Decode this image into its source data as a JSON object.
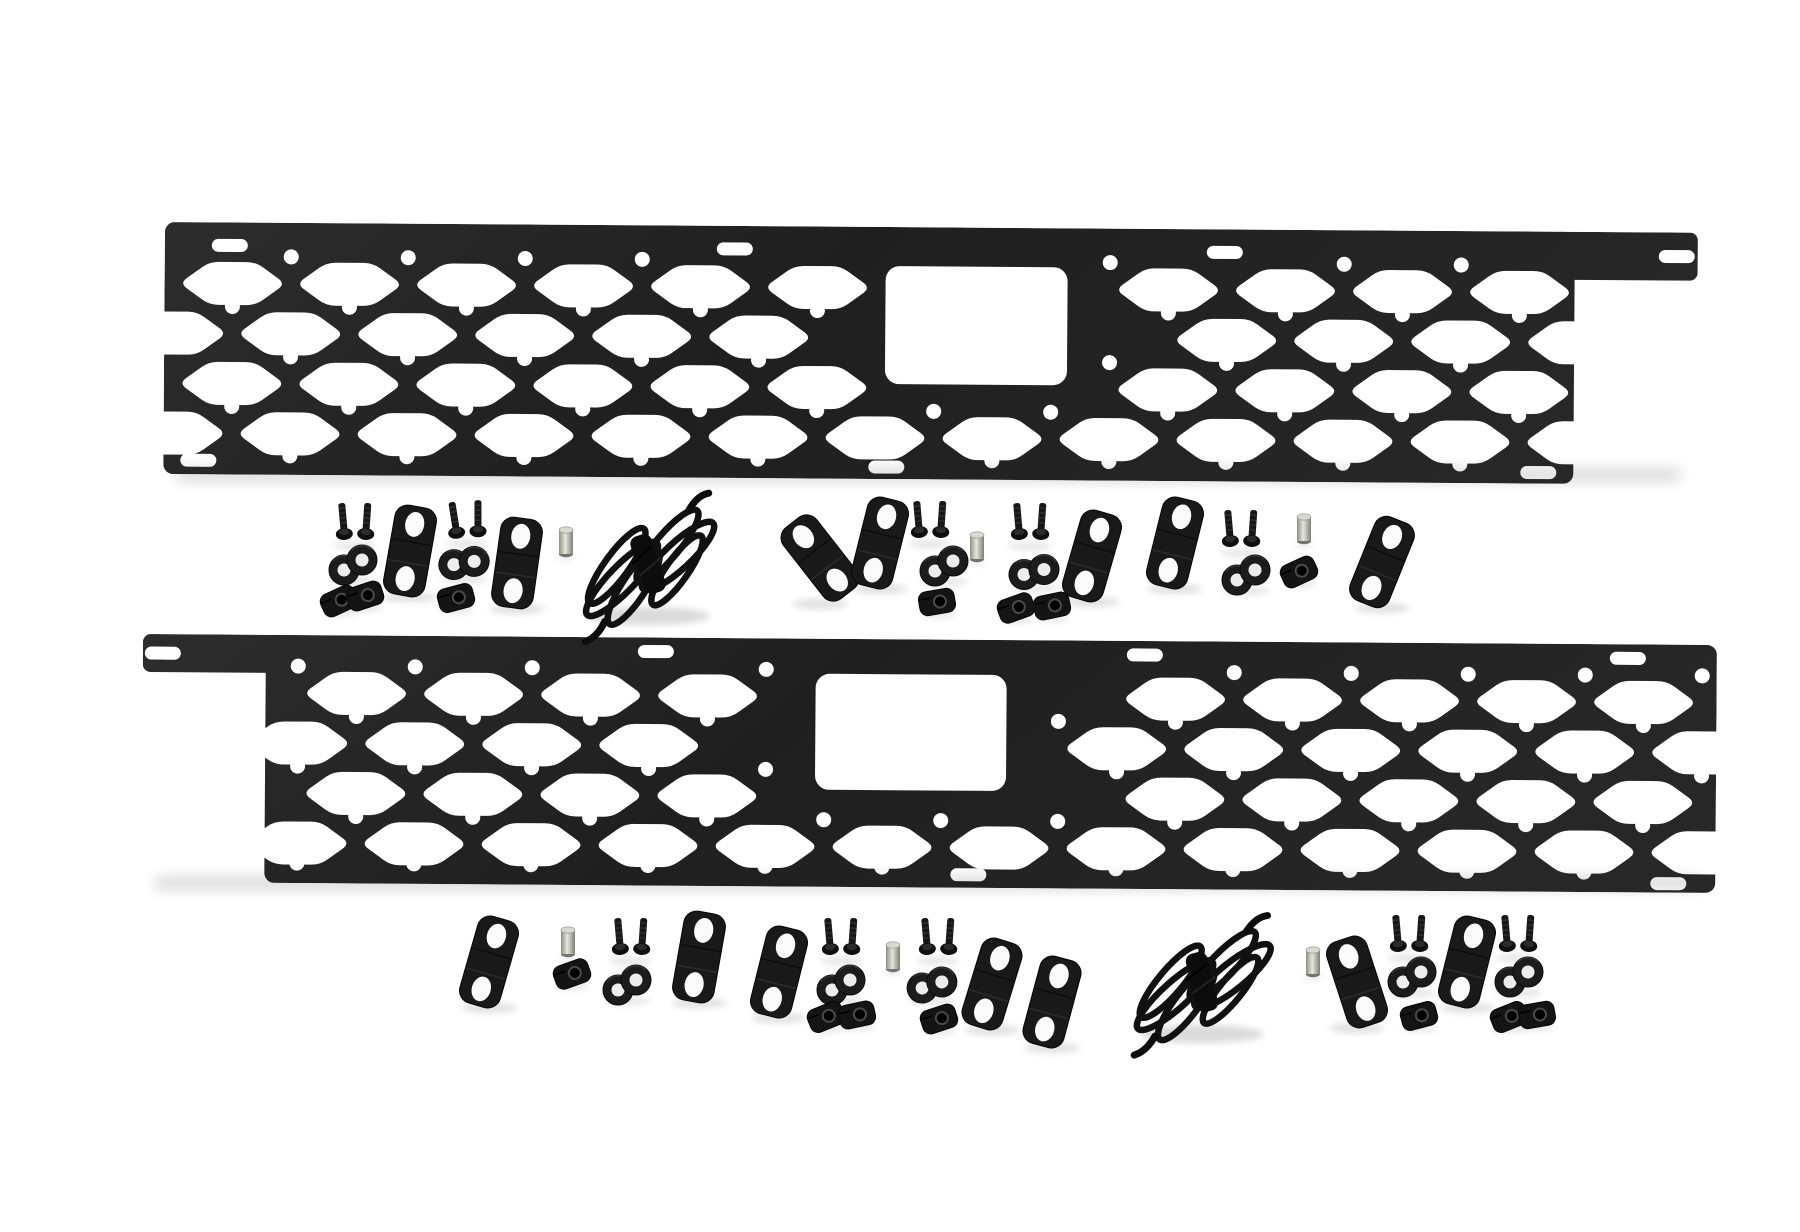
{
  "scene": {
    "type": "product-photo",
    "description": "Truck bed rail MOLLE panel kit: two long black powder-coated panels with hexagonal cutouts shown with mounting hardware (Z-brackets, button-head bolts, washers, U-clip nuts, threaded spacers, coiled rubber straps) on a white studio background.",
    "background_color": "#ffffff",
    "text_content": []
  },
  "palette": {
    "panel_dark": "#1f1f1f",
    "panel_mid": "#272727",
    "panel_light": "#2d2d2d",
    "hardware_black": "#171717",
    "hole_white": "#fbfbfb",
    "washer_hole": "#ededed",
    "stud_silver_light": "#e6e6df",
    "stud_silver_dark": "#8e8e88",
    "shadow": "#000000"
  },
  "kit_summary": {
    "molle_panels": 2,
    "z_brackets": 14,
    "bolt_pairs": 10,
    "washer_pairs": 10,
    "clip_nuts": 14,
    "spacer_studs": 6,
    "strap_coils": 2
  },
  "panels": [
    {
      "name": "molle-panel-top",
      "x": 125,
      "y": 206,
      "rotation": 0.4,
      "total_w": 1533,
      "body": {
        "x": 0,
        "w": 1410,
        "h": 252,
        "r": 10
      },
      "arm": {
        "x": 1385,
        "w": 148,
        "h": 48,
        "r": 8
      },
      "hex": {
        "w": 106,
        "h": 43,
        "taper": 30,
        "pitch": 117,
        "row_ys": [
          61,
          111,
          161,
          211
        ],
        "even_offset": 68,
        "odd_offset": 9.5,
        "field_x0": 12,
        "field_x1": 1398
      },
      "holes": {
        "r": 7.5,
        "line_ys": [
          34,
          84,
          134,
          184,
          233
        ],
        "offsets": [
          126.5,
          68
        ]
      },
      "rect_cutout": {
        "x": 721,
        "y": 39,
        "w": 182,
        "h": 118,
        "r": 14
      },
      "slot_size": {
        "w": 36,
        "h": 13,
        "r": 6.5
      },
      "slots": [
        [
          65,
          23
        ],
        [
          570,
          23
        ],
        [
          1060,
          23
        ],
        [
          1512,
          24
        ],
        [
          35,
          238
        ],
        [
          723,
          240
        ],
        [
          1375,
          241
        ]
      ]
    },
    {
      "name": "molle-panel-bottom",
      "x": 103,
      "y": 618,
      "rotation": 0.4,
      "total_w": 1574,
      "body": {
        "x": 123,
        "w": 1451,
        "h": 248,
        "r": 10
      },
      "arm": {
        "x": 0,
        "w": 148,
        "h": 38,
        "r": 8
      },
      "hex": {
        "w": 106,
        "h": 43,
        "taper": 30,
        "pitch": 117,
        "row_ys": [
          58,
          108,
          158,
          208
        ],
        "even_offset": 214,
        "odd_offset": 155.5,
        "field_x0": 136,
        "field_x1": 1560
      },
      "holes": {
        "r": 7.5,
        "line_ys": [
          31,
          81,
          131,
          181,
          228
        ],
        "offsets": [
          155.5,
          214
        ]
      },
      "rect_cutout": {
        "x": 673,
        "y": 35,
        "w": 191,
        "h": 116,
        "r": 14
      },
      "slot_size": {
        "w": 36,
        "h": 13,
        "r": 6.5
      },
      "slots": [
        [
          20,
          19
        ],
        [
          513,
          14
        ],
        [
          1002,
          14
        ],
        [
          1485,
          14
        ],
        [
          95,
          233
        ],
        [
          827,
          235
        ],
        [
          1527,
          239
        ]
      ]
    }
  ],
  "hardware_between_panels": [
    {
      "type": "screw-pair",
      "x": 315,
      "y": 514,
      "rot": 0
    },
    {
      "type": "washer-pair",
      "x": 313,
      "y": 549,
      "rot": 0
    },
    {
      "type": "clip-nut",
      "x": 299,
      "y": 585,
      "rot": -25
    },
    {
      "type": "clip-nut",
      "x": 325,
      "y": 580,
      "rot": -18
    },
    {
      "type": "z-bracket",
      "x": 370,
      "y": 535,
      "rot": 10
    },
    {
      "type": "screw-pair",
      "x": 427,
      "y": 512,
      "rot": -4
    },
    {
      "type": "washer-pair",
      "x": 424,
      "y": 547,
      "rot": 20
    },
    {
      "type": "clip-nut",
      "x": 416,
      "y": 582,
      "rot": -15
    },
    {
      "type": "z-bracket",
      "x": 477,
      "y": 547,
      "rot": 8
    },
    {
      "type": "spacer-stud",
      "x": 526,
      "y": 526,
      "rot": 0
    },
    {
      "type": "strap-coil",
      "x": 608,
      "y": 548,
      "rot": -30
    },
    {
      "type": "z-bracket",
      "x": 780,
      "y": 542,
      "rot": -38
    },
    {
      "type": "z-bracket",
      "x": 840,
      "y": 527,
      "rot": 14
    },
    {
      "type": "screw-pair",
      "x": 890,
      "y": 512,
      "rot": 0
    },
    {
      "type": "washer-pair",
      "x": 904,
      "y": 550,
      "rot": 0
    },
    {
      "type": "clip-nut",
      "x": 897,
      "y": 586,
      "rot": -10
    },
    {
      "type": "spacer-stud",
      "x": 937,
      "y": 531,
      "rot": 0
    },
    {
      "type": "screw-pair",
      "x": 990,
      "y": 514,
      "rot": 0
    },
    {
      "type": "washer-pair",
      "x": 994,
      "y": 556,
      "rot": 15
    },
    {
      "type": "clip-nut",
      "x": 976,
      "y": 592,
      "rot": -20
    },
    {
      "type": "clip-nut",
      "x": 1012,
      "y": 590,
      "rot": -12
    },
    {
      "type": "z-bracket",
      "x": 1052,
      "y": 540,
      "rot": 16
    },
    {
      "type": "z-bracket",
      "x": 1135,
      "y": 527,
      "rot": 14
    },
    {
      "type": "screw-pair",
      "x": 1201,
      "y": 521,
      "rot": 0
    },
    {
      "type": "washer-pair",
      "x": 1206,
      "y": 559,
      "rot": 0
    },
    {
      "type": "spacer-stud",
      "x": 1264,
      "y": 513,
      "rot": 0
    },
    {
      "type": "clip-nut",
      "x": 1259,
      "y": 556,
      "rot": -25
    },
    {
      "type": "z-bracket",
      "x": 1342,
      "y": 546,
      "rot": 22
    }
  ],
  "hardware_below_panels": [
    {
      "type": "z-bracket",
      "x": 449,
      "y": 946,
      "rot": 16
    },
    {
      "type": "spacer-stud",
      "x": 528,
      "y": 926,
      "rot": 0
    },
    {
      "type": "clip-nut",
      "x": 532,
      "y": 958,
      "rot": -20
    },
    {
      "type": "screw-pair",
      "x": 591,
      "y": 929,
      "rot": 0
    },
    {
      "type": "washer-pair",
      "x": 587,
      "y": 969,
      "rot": 0
    },
    {
      "type": "z-bracket",
      "x": 659,
      "y": 941,
      "rot": 10
    },
    {
      "type": "z-bracket",
      "x": 739,
      "y": 956,
      "rot": 14
    },
    {
      "type": "screw-pair",
      "x": 801,
      "y": 929,
      "rot": 0
    },
    {
      "type": "washer-pair",
      "x": 801,
      "y": 969,
      "rot": 0
    },
    {
      "type": "clip-nut",
      "x": 786,
      "y": 1001,
      "rot": -22
    },
    {
      "type": "clip-nut",
      "x": 817,
      "y": 999,
      "rot": -12
    },
    {
      "type": "spacer-stud",
      "x": 853,
      "y": 941,
      "rot": 0
    },
    {
      "type": "screw-pair",
      "x": 898,
      "y": 929,
      "rot": 0
    },
    {
      "type": "washer-pair",
      "x": 892,
      "y": 969,
      "rot": 12
    },
    {
      "type": "clip-nut",
      "x": 899,
      "y": 1003,
      "rot": -18
    },
    {
      "type": "z-bracket",
      "x": 952,
      "y": 968,
      "rot": 17
    },
    {
      "type": "z-bracket",
      "x": 1012,
      "y": 986,
      "rot": 15
    },
    {
      "type": "strap-coil",
      "x": 1162,
      "y": 966,
      "rot": -26
    },
    {
      "type": "spacer-stud",
      "x": 1273,
      "y": 946,
      "rot": 0
    },
    {
      "type": "z-bracket",
      "x": 1317,
      "y": 966,
      "rot": -18
    },
    {
      "type": "screw-pair",
      "x": 1369,
      "y": 926,
      "rot": 0
    },
    {
      "type": "washer-pair",
      "x": 1372,
      "y": 961,
      "rot": 0
    },
    {
      "type": "clip-nut",
      "x": 1379,
      "y": 1000,
      "rot": -15
    },
    {
      "type": "z-bracket",
      "x": 1427,
      "y": 946,
      "rot": 14
    },
    {
      "type": "screw-pair",
      "x": 1478,
      "y": 926,
      "rot": 0
    },
    {
      "type": "washer-pair",
      "x": 1479,
      "y": 961,
      "rot": 0
    },
    {
      "type": "clip-nut",
      "x": 1469,
      "y": 1001,
      "rot": -22
    },
    {
      "type": "clip-nut",
      "x": 1497,
      "y": 999,
      "rot": -10
    }
  ]
}
